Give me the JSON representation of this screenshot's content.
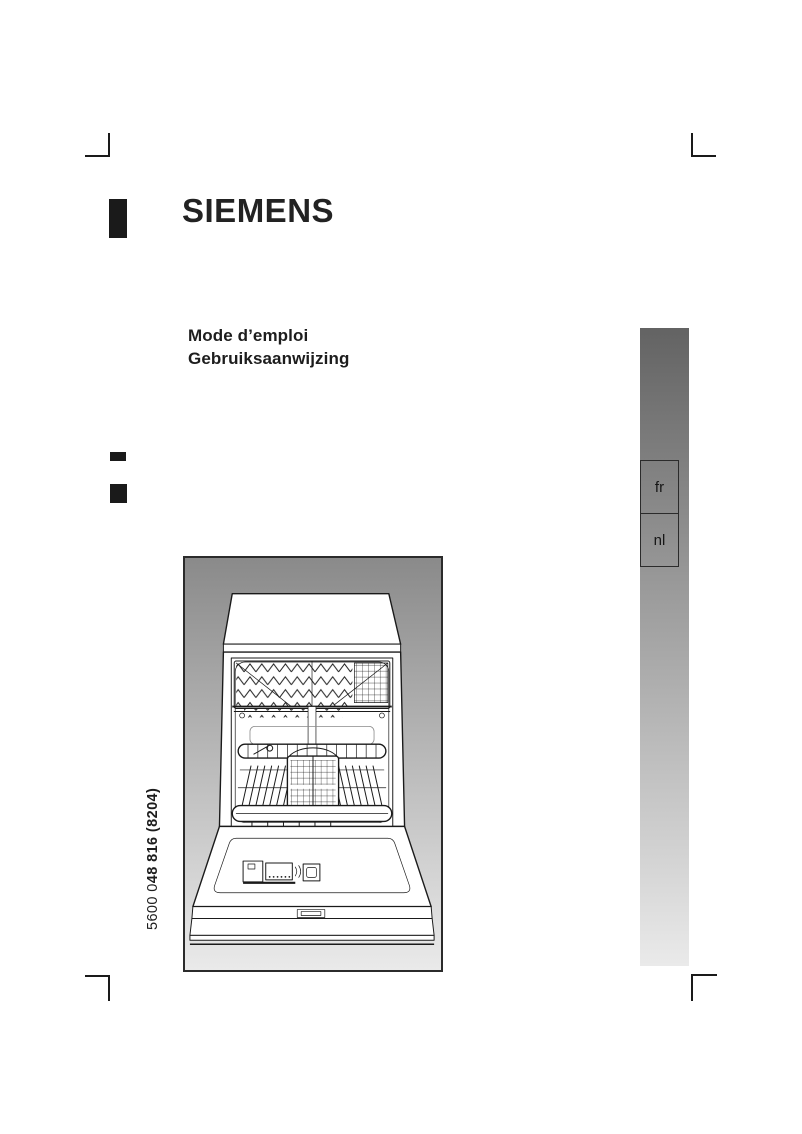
{
  "document": {
    "brand_logo": "SIEMENS",
    "title_fr": "Mode d’emploi",
    "title_nl": "Gebruiksaanwijzing",
    "part_number": {
      "prefix": "5600 0",
      "emphasis": "48 816 (8204)"
    }
  },
  "language_bar": {
    "tabs": [
      {
        "label": "fr"
      },
      {
        "label": "nl"
      }
    ],
    "gradient_top": "#636363",
    "gradient_bottom": "#eaeaea"
  },
  "illustration": {
    "name": "dishwasher-front-open",
    "gradient_top": "#8a8a8a",
    "gradient_bottom": "#eaeaea",
    "border_color": "#2b2b2b"
  },
  "print_marks": {
    "color": "#1a1a1a"
  }
}
